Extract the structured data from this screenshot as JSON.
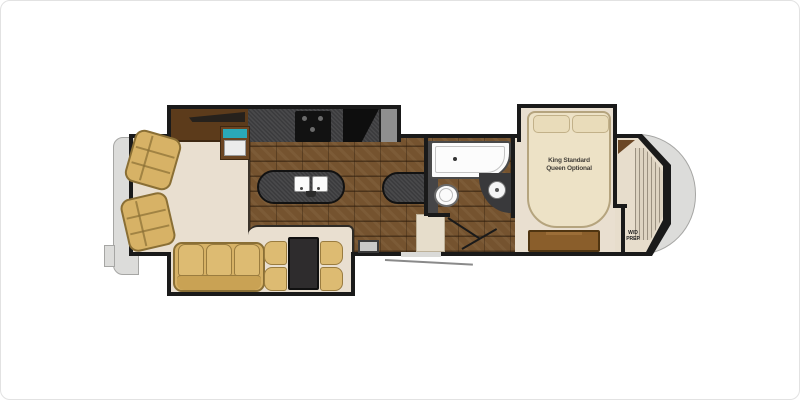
{
  "floorplan": {
    "vehicle": "fifth-wheel RV floor plan",
    "labels": {
      "bed_line1": "King Standard",
      "bed_line2": "Queen Optional",
      "wd_line1": "W/D",
      "wd_line2": "PREP"
    },
    "rooms": [
      "living area",
      "kitchen",
      "bathroom",
      "bedroom",
      "front wardrobe closet"
    ],
    "fixtures": [
      "recliner",
      "recliner",
      "entertainment-center",
      "fireplace",
      "tv",
      "kitchen-counter",
      "range",
      "refrigerator",
      "pantry",
      "kitchen-island",
      "double-sink",
      "peninsula-counter",
      "tub-shower",
      "toilet",
      "vanity-sink",
      "bed",
      "dresser",
      "corner-shelf",
      "wardrobe",
      "tri-fold-sofa",
      "dinette-table",
      "dinette-chair",
      "dinette-chair",
      "dinette-chair",
      "dinette-chair",
      "entry-step",
      "entry-door",
      "rear-ladder"
    ],
    "colors": {
      "wall": "#1a1a1a",
      "carpet": "#e9dfd0",
      "tile": "#75532f",
      "counter": "#3b3b3d",
      "cabinet": "#5c3b1b",
      "furniture_tan": "#d7b266",
      "bed_cream": "#ede2c6",
      "cap_gray": "#dcdcda",
      "tv_teal": "#2aa9b8",
      "fixture_white": "#fdfdfd"
    }
  }
}
